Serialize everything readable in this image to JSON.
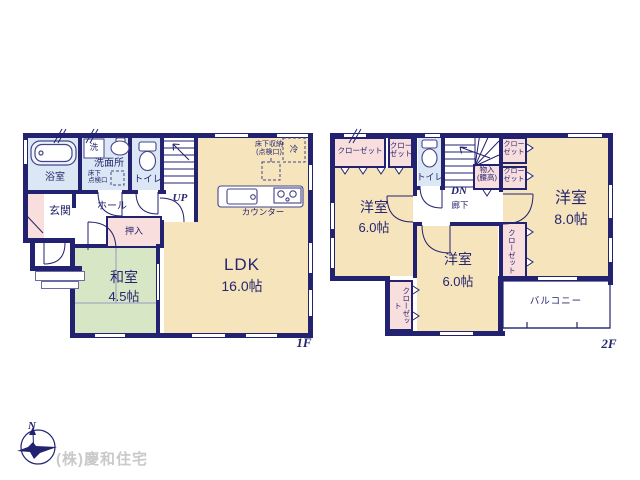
{
  "colors": {
    "wall": "#232270",
    "living_beige": "#f6e4bd",
    "tatami_green": "#d7e6c5",
    "wet_blue": "#dbe7f4",
    "closet_pink": "#f9dede",
    "company_gray": "#c9c9c9"
  },
  "compass": {
    "n": "N"
  },
  "footer": {
    "company": "(株)慶和住宅"
  },
  "floor1": {
    "floor_label": "1F",
    "bathroom": "浴室",
    "laundry": "洗",
    "washroom": "洗面所",
    "underfloor_hatch": "床下\n点検口",
    "toilet": "トイレ",
    "stairs_up": "UP",
    "entrance": "玄関",
    "hall": "ホール",
    "oshiire": "押入",
    "tatami_room": "和室",
    "tatami_size": "4.5帖",
    "ldk": "LDK",
    "ldk_size": "16.0帖",
    "underfloor_storage": "床下収納\n(点検口)",
    "fridge": "冷",
    "counter": "カウンター"
  },
  "floor2": {
    "floor_label": "2F",
    "closet_wide": "クローゼット",
    "closet_small": "クロー\nゼット",
    "toilet": "トイレ",
    "stairs_down": "DN",
    "corridor": "廊下",
    "storage_waist": "物入\n(腰高)",
    "closet_right_top": "クロー\nゼット",
    "closet_right_mid": "クロー\nゼット",
    "closet_right_vert": "クローゼット",
    "closet_left_vert": "クローゼット",
    "room_west": "洋室",
    "room_west_size": "6.0帖",
    "room_south": "洋室",
    "room_south_size": "6.0帖",
    "room_east": "洋室",
    "room_east_size": "8.0帖",
    "balcony": "バルコニー"
  }
}
